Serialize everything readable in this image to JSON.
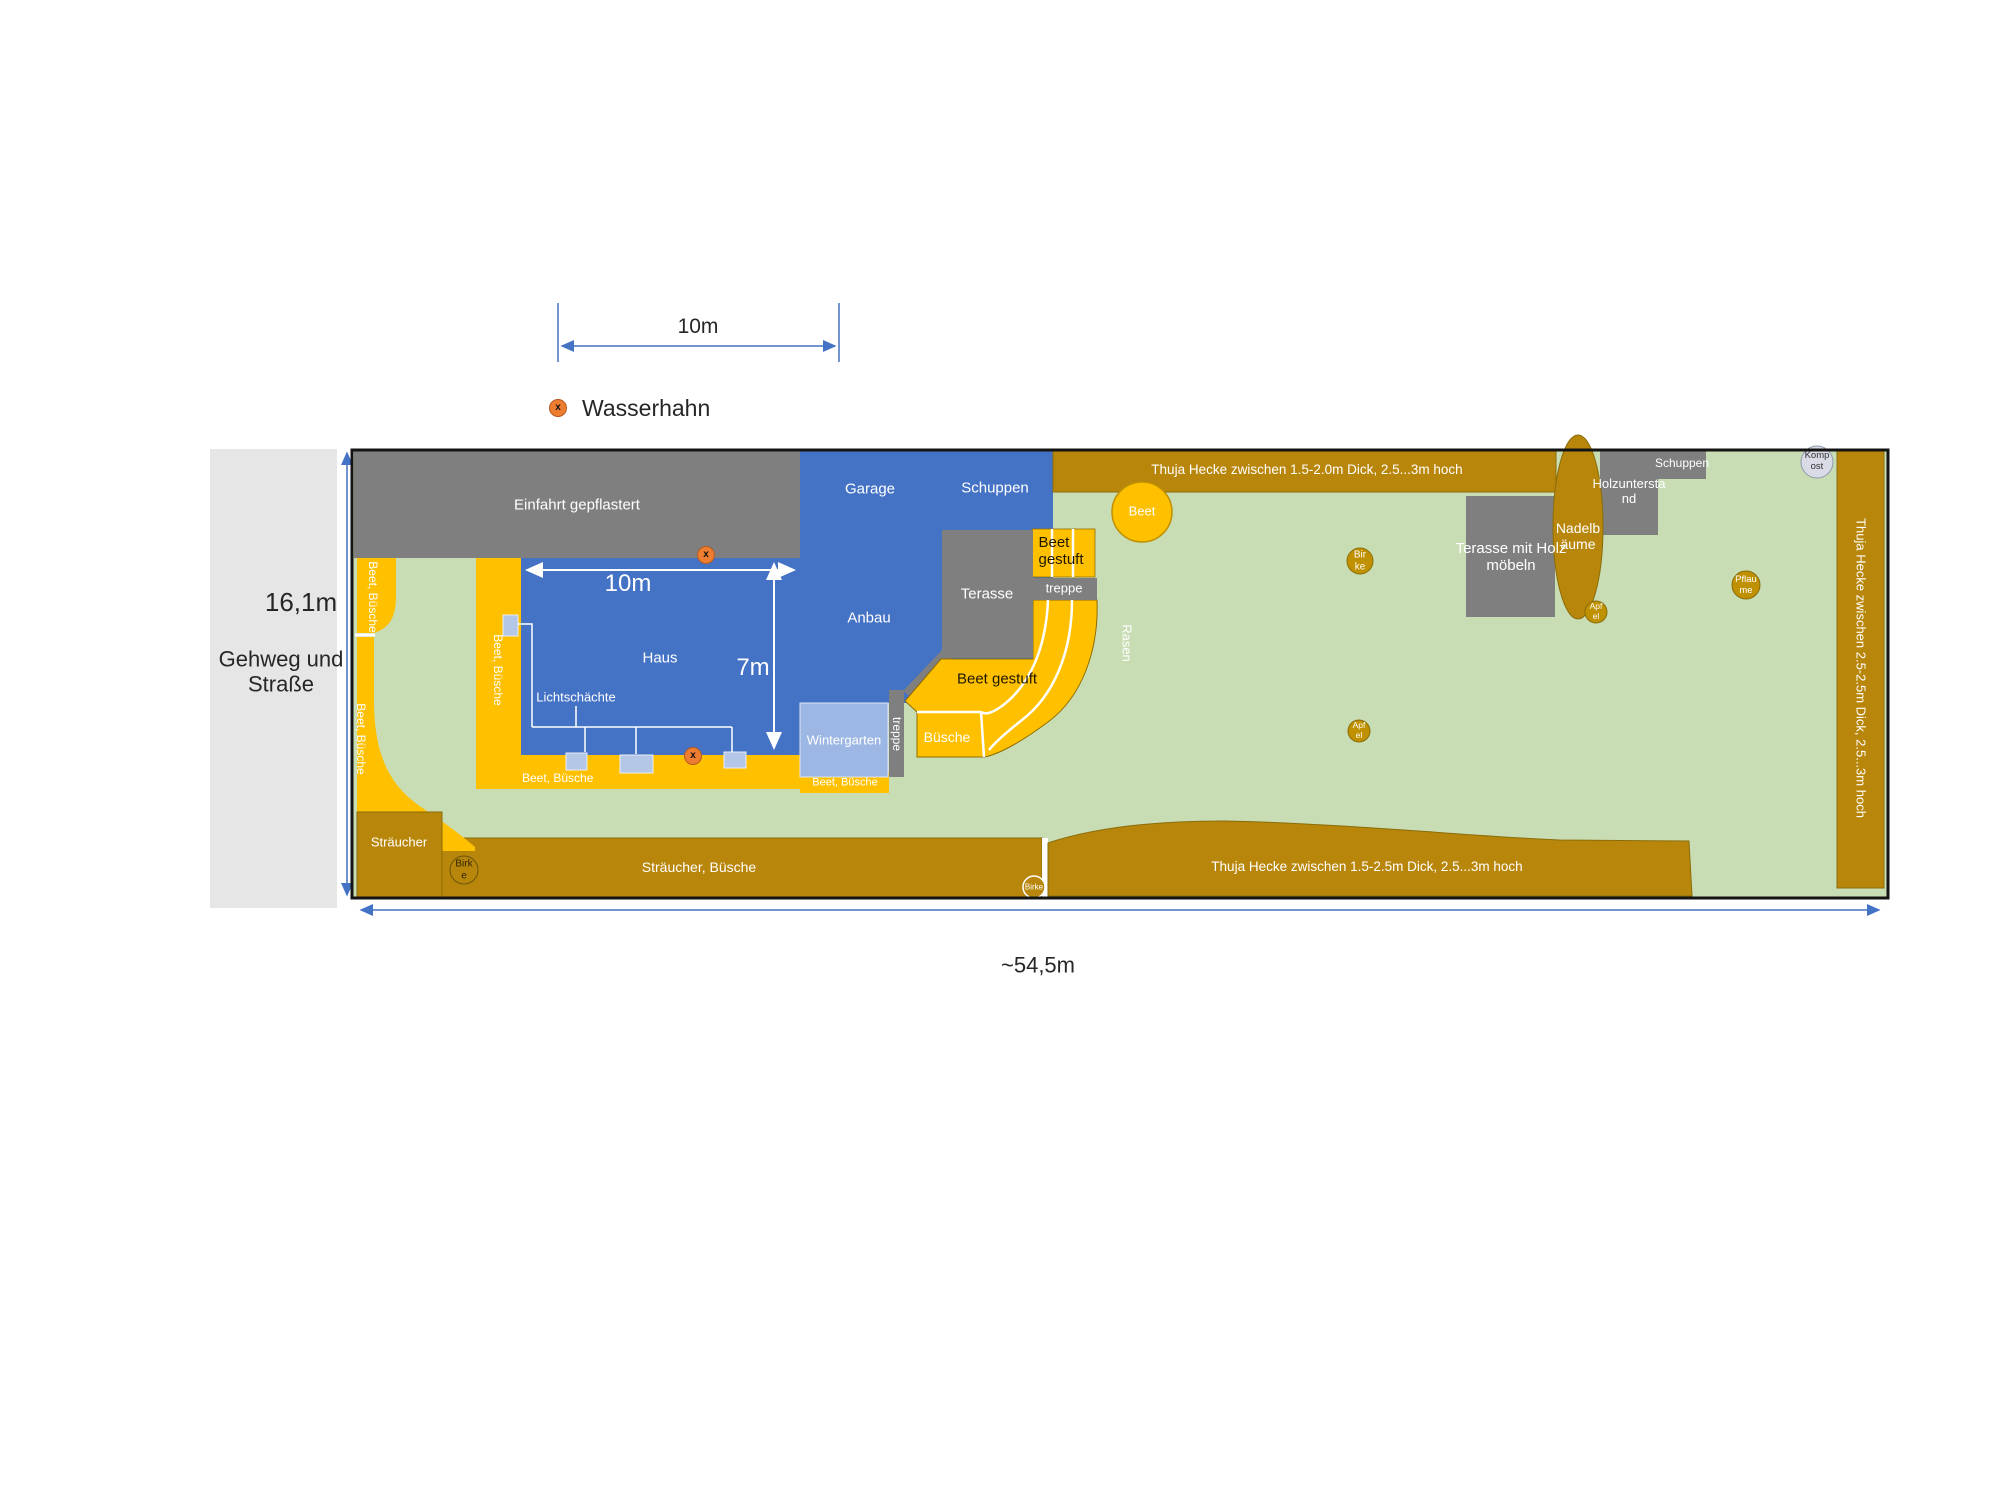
{
  "scalebar": {
    "label": "10m"
  },
  "legend": {
    "tap_label": "Wasserhahn",
    "tap_glyph": "x"
  },
  "sidewalk": {
    "height_label": "16,1m",
    "name": "Gehweg und\nStraße"
  },
  "dimensions": {
    "total_width": "~54,5m",
    "house_width": "10m",
    "house_depth": "7m"
  },
  "plan": {
    "einfahrt": "Einfahrt gepflastert",
    "garage": "Garage",
    "schuppen_main": "Schuppen",
    "anbau": "Anbau",
    "haus": "Haus",
    "lichtschaechte": "Lichtschächte",
    "wintergarten": "Wintergarten",
    "treppe_vertical": "treppe",
    "treppe_horizontal": "treppe",
    "terasse": "Terasse",
    "beet_gestuft_top": "Beet\ngestuft",
    "beet_gestuft_lower": "Beet gestuft",
    "buesche": "Büsche",
    "rasen": "Rasen",
    "beet_circle": "Beet",
    "beet_buesche_strip1_upper": "Beet, Büsche",
    "beet_buesche_strip1_lower": "Beet, Büsche",
    "beet_buesche_strip2": "Beet, Büsche",
    "beet_buesche_bottom_a": "Beet, Büsche",
    "beet_buesche_bottom_b": "Beet, Büsche",
    "hedge_top": "Thuja Hecke zwischen 1.5-2.0m Dick, 2.5...3m hoch",
    "hedge_bottom": "Thuja Hecke zwischen 1.5-2.5m Dick, 2.5...3m hoch",
    "hedge_right": "Thuja Hecke zwischen 2.5-2.5m Dick, 2.5...3m hoch",
    "terasse_holz": "Terasse mit Holz\nmöbeln",
    "nadelbaeume": "Nadelb\näume",
    "holzunterstand": "Holzuntersta\nnd",
    "schuppen_right": "Schuppen",
    "kompost": "Komp\nost",
    "straeucher": "Sträucher",
    "straeucher_buesche": "Sträucher, Büsche",
    "trees": {
      "birke_left": "Birk\ne",
      "birke_bottom": "Birke",
      "birke_mid": "Bir\nke",
      "apfel_mid": "Apf\nel",
      "apfel_right": "Apf\nel",
      "pflaume": "Pflau\nme"
    }
  },
  "colors": {
    "lawn": "#C9DDB5",
    "hedge": "#B8860B",
    "bed_yellow": "#FFC000",
    "building_blue": "#4472C4",
    "wintergarten_blue": "#9CB7E3",
    "lightwell_blue": "#B4C7E7",
    "paving_gray": "#7F7F7F",
    "sidewalk_gray": "#E7E6E6",
    "dimension_blue": "#4472C4",
    "tap_orange": "#ED7D31",
    "tree_gold": "#BF9000",
    "kompost_gray": "#D9DCE6"
  }
}
